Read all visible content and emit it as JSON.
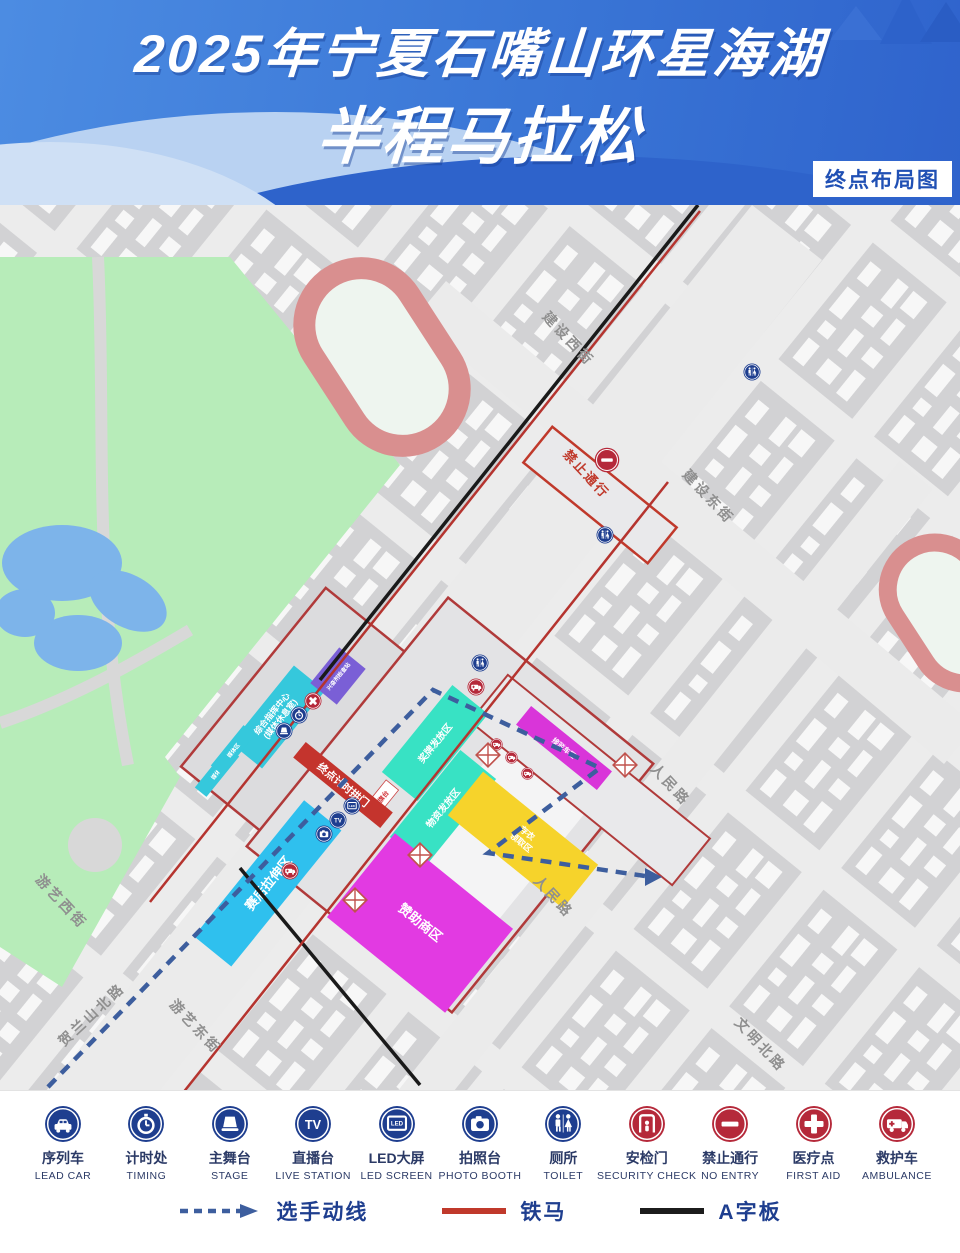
{
  "header": {
    "title_line1": "2025年宁夏石嘴山环星海湖",
    "title_line2": "半程马拉松",
    "corner_badge": "终点布局图"
  },
  "map": {
    "no_entry_text": "禁止通行",
    "streets": [
      {
        "label": "建设西街"
      },
      {
        "label": "建设东街"
      },
      {
        "label": "人民路"
      },
      {
        "label": "人民路"
      },
      {
        "label": "游艺西街"
      },
      {
        "label": "游艺东街"
      },
      {
        "label": "贺兰山北路"
      },
      {
        "label": "文明北路"
      }
    ],
    "zones": [
      {
        "name": "finish-arch",
        "label": "终点计时拱门",
        "color": "#c4342d"
      },
      {
        "name": "command-center",
        "label": "综合指挥中心",
        "label2": "(媒体休息室)",
        "color": "#35c8dc"
      },
      {
        "name": "doping-control",
        "label": "兴奋剂检查站",
        "color": "#7a5fd6"
      },
      {
        "name": "medal-zone",
        "label": "奖牌发放区",
        "color": "#38e2c4"
      },
      {
        "name": "supply-zone",
        "label": "物资发放区",
        "color": "#38e2c4"
      },
      {
        "name": "stretch-zone",
        "label": "赛后拉伸区",
        "color": "#2fc0ee"
      },
      {
        "name": "sponsor-zone",
        "label": "赞助商区",
        "color": "#e23ae2"
      },
      {
        "name": "bag-claim-zone",
        "label": "存衣",
        "label2": "领取区",
        "color": "#f6d32b"
      },
      {
        "name": "shuttle-zone",
        "label": "接驳车区",
        "color": "#d935d9"
      },
      {
        "name": "media-strip-a",
        "label": "媒体区",
        "color": "#35c8dc"
      },
      {
        "name": "media-strip-b",
        "label": "媒体区",
        "color": "#35c8dc"
      },
      {
        "name": "flag-platform",
        "label": "升旗台",
        "color": "#ffffff"
      }
    ]
  },
  "legend": {
    "items": [
      {
        "zh": "序列车",
        "en": "LEAD CAR",
        "icon": "lead-car",
        "color": "#1e3e8f"
      },
      {
        "zh": "计时处",
        "en": "TIMING",
        "icon": "timing",
        "color": "#1e3e8f"
      },
      {
        "zh": "主舞台",
        "en": "STAGE",
        "icon": "stage",
        "color": "#1e3e8f"
      },
      {
        "zh": "直播台",
        "en": "LIVE STATION",
        "icon": "tv",
        "color": "#1e3e8f"
      },
      {
        "zh": "LED大屏",
        "en": "LED SCREEN",
        "icon": "led",
        "color": "#1e3e8f"
      },
      {
        "zh": "拍照台",
        "en": "PHOTO BOOTH",
        "icon": "photo",
        "color": "#1e3e8f"
      },
      {
        "zh": "厕所",
        "en": "TOILET",
        "icon": "toilet",
        "color": "#1e3e8f"
      },
      {
        "zh": "安检门",
        "en": "SECURITY CHECK",
        "icon": "security",
        "color": "#b5293a"
      },
      {
        "zh": "禁止通行",
        "en": "NO ENTRY",
        "icon": "no-entry",
        "color": "#b5293a"
      },
      {
        "zh": "医疗点",
        "en": "FIRST AID",
        "icon": "first-aid",
        "color": "#b5293a"
      },
      {
        "zh": "救护车",
        "en": "AMBULANCE",
        "icon": "ambulance",
        "color": "#b5293a"
      }
    ],
    "lines": [
      {
        "label": "选手动线"
      },
      {
        "label": "铁马"
      },
      {
        "label": "A字板"
      }
    ]
  }
}
